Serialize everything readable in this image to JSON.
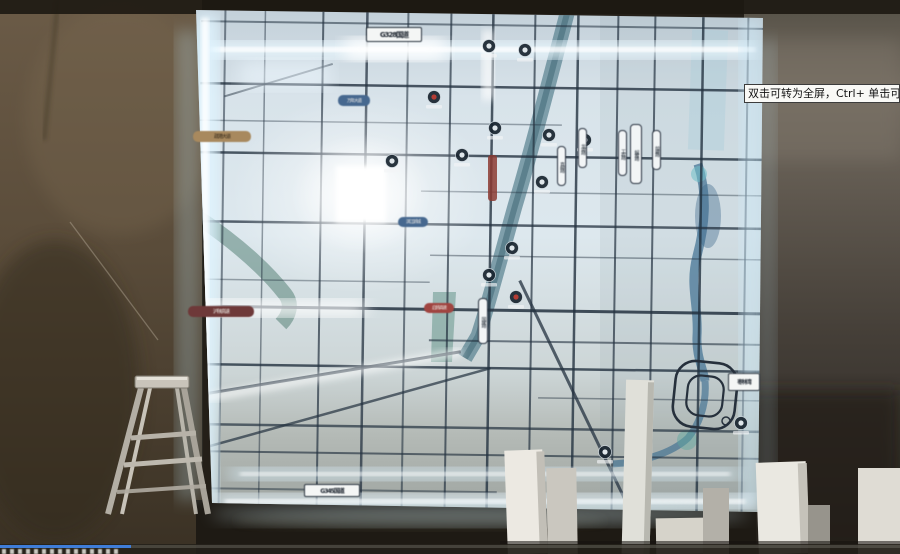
{
  "player": {
    "tooltip_text": "双击可转为全屏，Ctrl+ 单击可转为",
    "progress_percent": 14.5,
    "progress_color": "#3f7dd8"
  },
  "map": {
    "labels": [
      {
        "text": "G328国道"
      },
      {
        "text": "G345国道"
      },
      {
        "text": "疏港大道"
      },
      {
        "text": "沪陕高速"
      },
      {
        "text": "启扬高速"
      },
      {
        "text": "枣林湾"
      },
      {
        "text": "万年大道"
      },
      {
        "text": "滨江新城"
      },
      {
        "text": "真州路"
      },
      {
        "text": "龙河路"
      },
      {
        "text": "工农路"
      },
      {
        "text": "解放路"
      },
      {
        "text": "前进路"
      },
      {
        "text": "国庆路"
      }
    ],
    "colors": {
      "panel_glow": "#eaf8ff",
      "road": "#243240",
      "river": "#57808f",
      "highlight": "#ffffff"
    }
  },
  "icons": {
    "project_badge": "circle-logo-marker",
    "river_ring": "interchange-loop"
  }
}
